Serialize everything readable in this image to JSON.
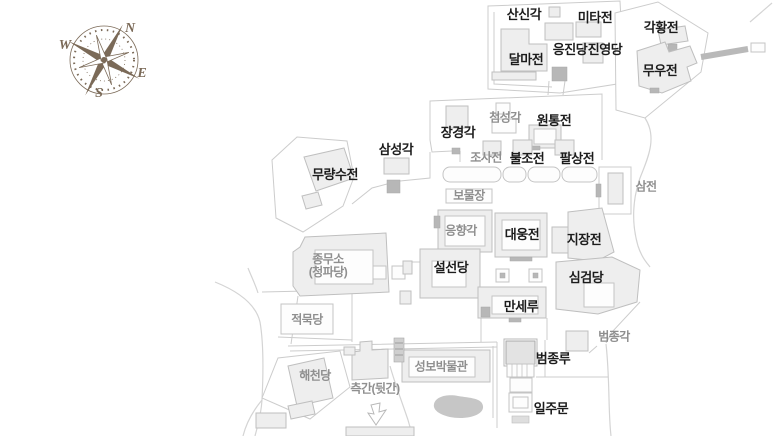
{
  "map_title": "temple-grounds-map",
  "colors": {
    "background": "#ffffff",
    "building_fill": "#eeeeee",
    "building_stroke": "#bfbfbf",
    "wall_stroke": "#cccccc",
    "dark_feature": "#b7b7b7",
    "pond": "#c6c6c6",
    "label_major": "#1c1c1c",
    "label_minor": "#8f8f8f",
    "compass": "#7b6a58"
  },
  "compass": {
    "n": "N",
    "e": "E",
    "s": "S",
    "w": "W"
  },
  "labels": [
    {
      "text": "산신각",
      "x": 524,
      "y": 15,
      "style": "major"
    },
    {
      "text": "미타전",
      "x": 595,
      "y": 18,
      "style": "major"
    },
    {
      "text": "각황전",
      "x": 661,
      "y": 28,
      "style": "major"
    },
    {
      "text": "달마전",
      "x": 526,
      "y": 60,
      "style": "major"
    },
    {
      "text": "응진당",
      "x": 570,
      "y": 50,
      "style": "major"
    },
    {
      "text": "진영당",
      "x": 605,
      "y": 50,
      "style": "major"
    },
    {
      "text": "무우전",
      "x": 660,
      "y": 71,
      "style": "major"
    },
    {
      "text": "장경각",
      "x": 458,
      "y": 133,
      "style": "major"
    },
    {
      "text": "첨성각",
      "x": 505,
      "y": 118,
      "style": "minor"
    },
    {
      "text": "원통전",
      "x": 554,
      "y": 121,
      "style": "major"
    },
    {
      "text": "조사전",
      "x": 486,
      "y": 158,
      "style": "minor"
    },
    {
      "text": "불조전",
      "x": 527,
      "y": 159,
      "style": "major"
    },
    {
      "text": "팔상전",
      "x": 577,
      "y": 159,
      "style": "major"
    },
    {
      "text": "삼전",
      "x": 646,
      "y": 187,
      "style": "minor"
    },
    {
      "text": "삼성각",
      "x": 396,
      "y": 150,
      "style": "major"
    },
    {
      "text": "무량수전",
      "x": 335,
      "y": 175,
      "style": "major"
    },
    {
      "text": "보물장",
      "x": 469,
      "y": 196,
      "style": "minor"
    },
    {
      "text": "응향각",
      "x": 461,
      "y": 231,
      "style": "minor"
    },
    {
      "text": "대웅전",
      "x": 522,
      "y": 235,
      "style": "major"
    },
    {
      "text": "지장전",
      "x": 584,
      "y": 240,
      "style": "major"
    },
    {
      "text": "종무소\n(청파당)",
      "x": 328,
      "y": 266,
      "style": "minor"
    },
    {
      "text": "설선당",
      "x": 451,
      "y": 268,
      "style": "major"
    },
    {
      "text": "심검당",
      "x": 586,
      "y": 278,
      "style": "major"
    },
    {
      "text": "만세루",
      "x": 521,
      "y": 307,
      "style": "major"
    },
    {
      "text": "적묵당",
      "x": 307,
      "y": 320,
      "style": "minor"
    },
    {
      "text": "해천당",
      "x": 315,
      "y": 376,
      "style": "minor"
    },
    {
      "text": "측간(뒷간)",
      "x": 375,
      "y": 389,
      "style": "minor"
    },
    {
      "text": "성보박물관",
      "x": 441,
      "y": 367,
      "style": "minor"
    },
    {
      "text": "범종루",
      "x": 553,
      "y": 359,
      "style": "major"
    },
    {
      "text": "일주문",
      "x": 551,
      "y": 409,
      "style": "major"
    },
    {
      "text": "범종각",
      "x": 614,
      "y": 337,
      "style": "minor"
    }
  ]
}
